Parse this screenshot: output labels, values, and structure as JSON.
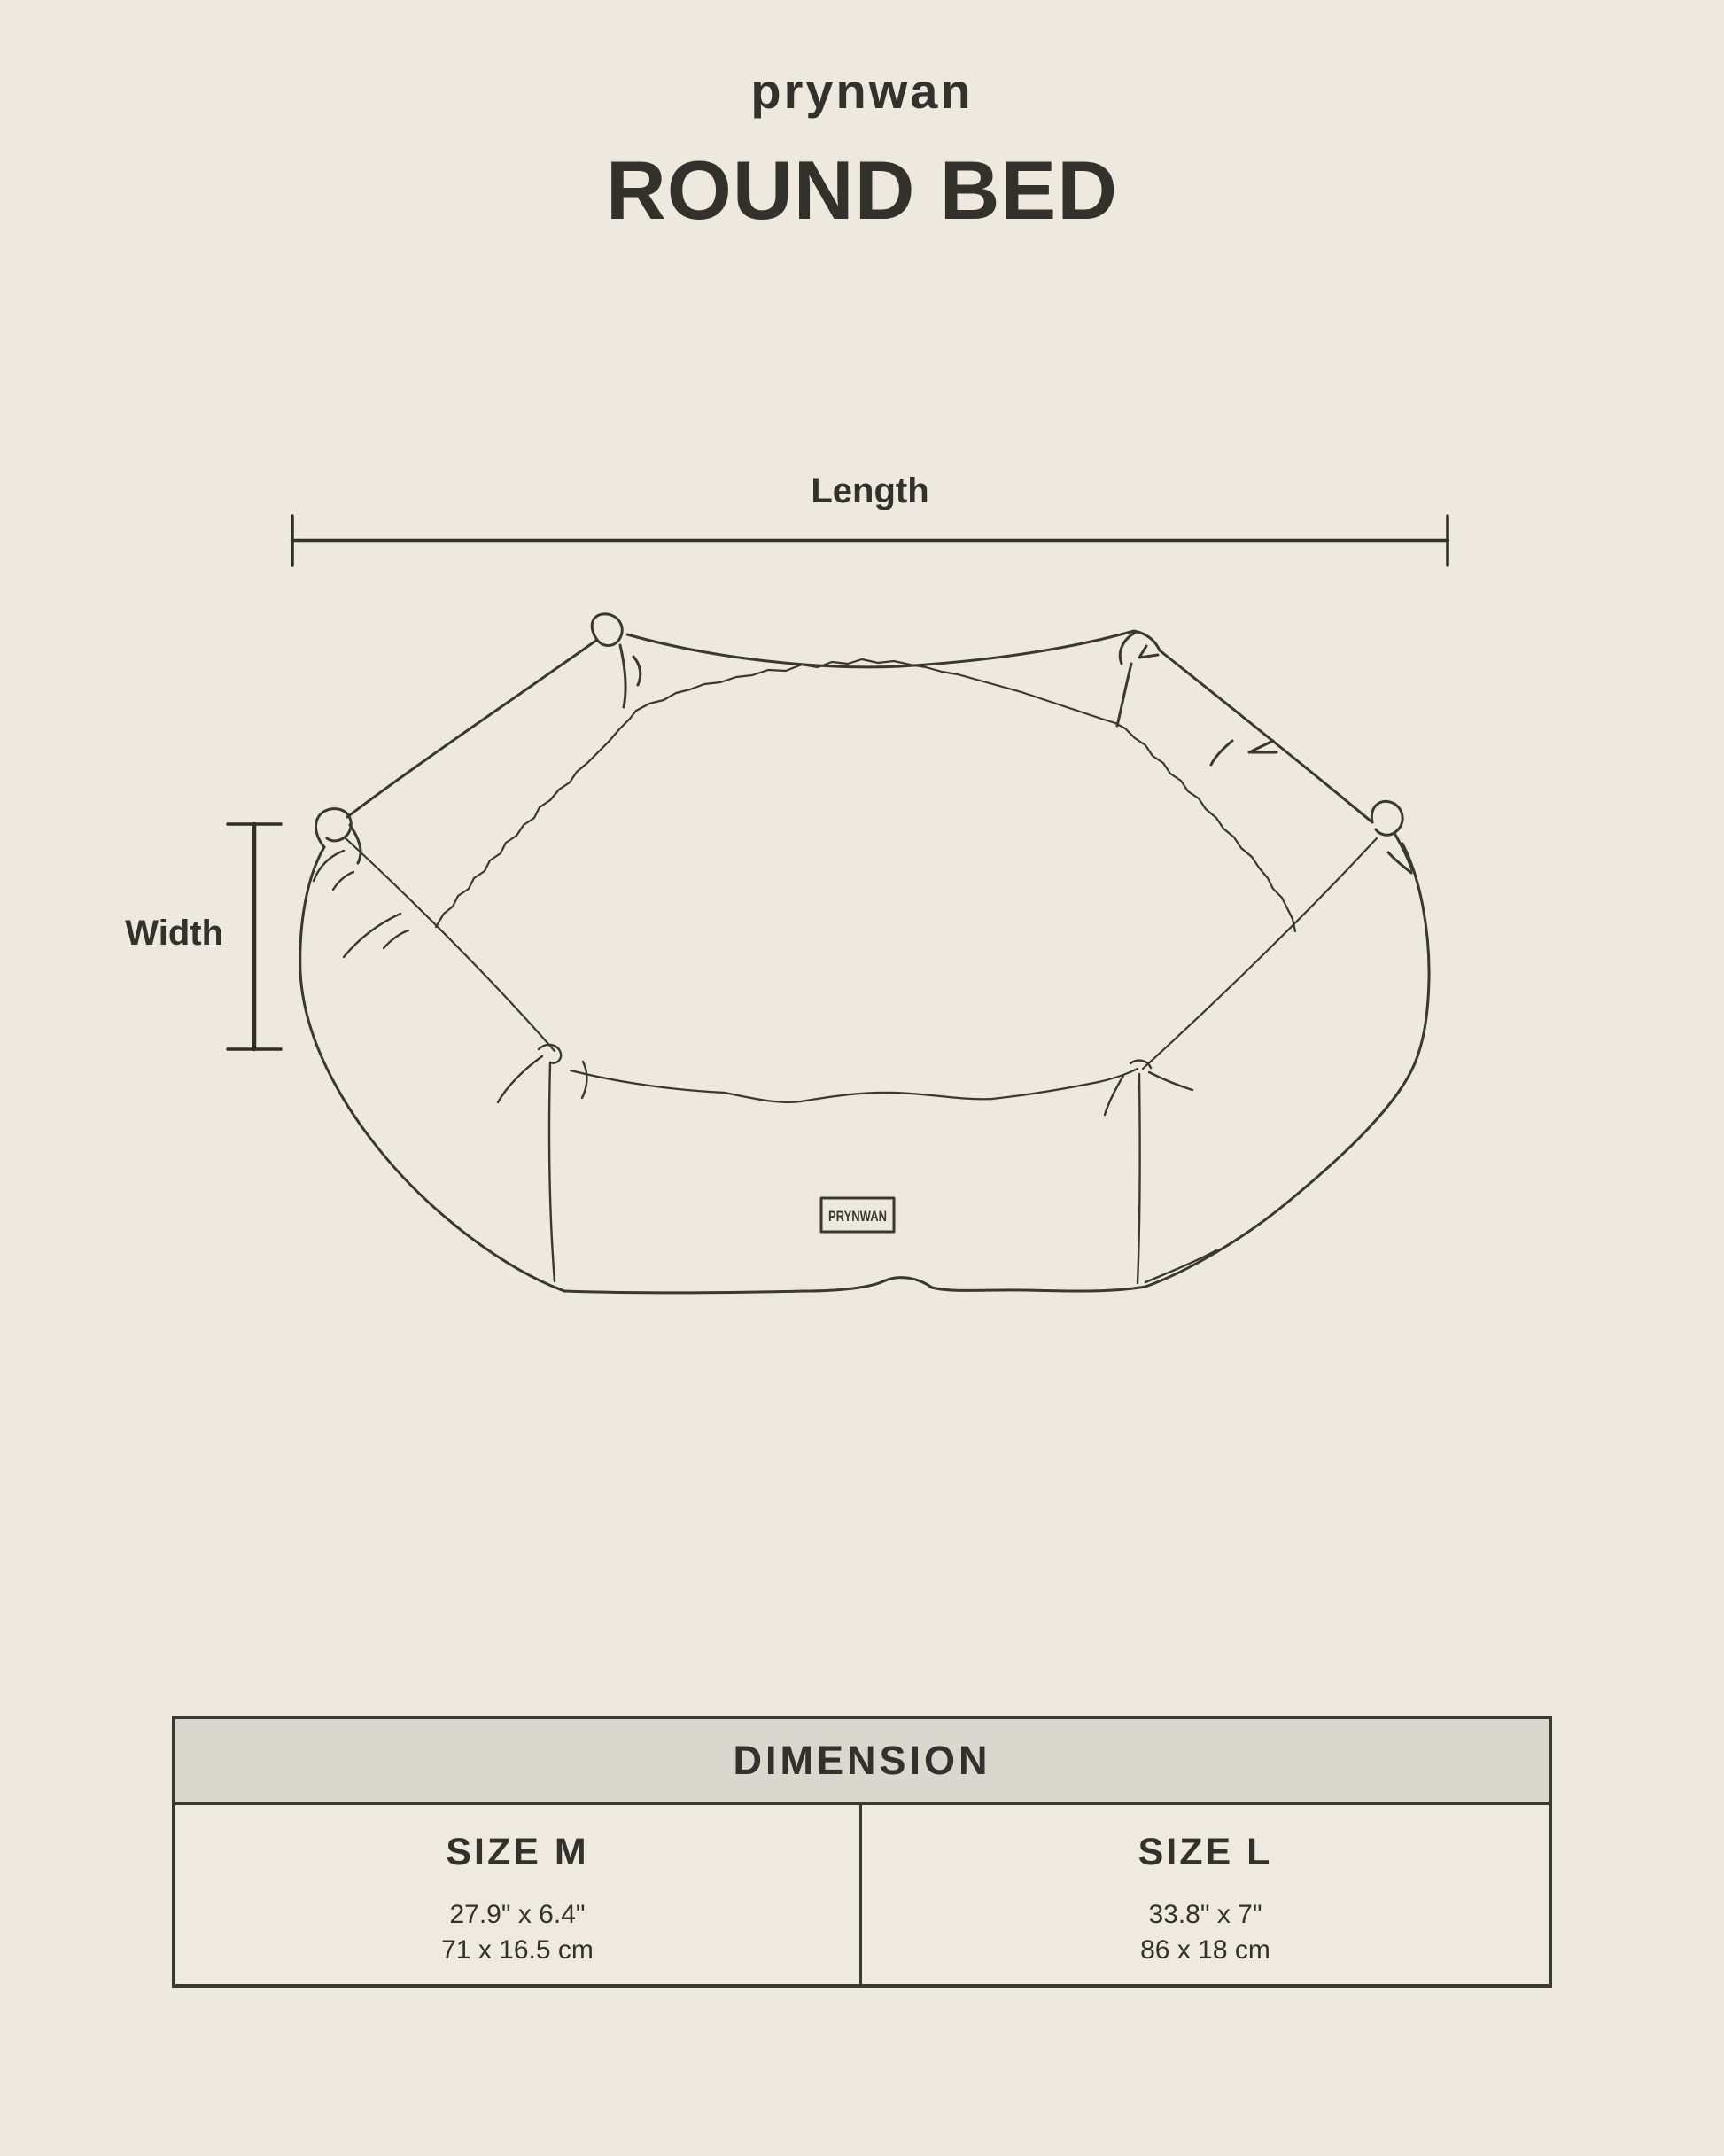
{
  "brand": "prynwan",
  "title": "ROUND BED",
  "diagram": {
    "length_label": "Length",
    "width_label": "Width",
    "bed_tag": "PRYNWAN"
  },
  "table": {
    "header": "DIMENSION",
    "columns": [
      {
        "size": "SIZE M",
        "inches": "27.9\" x 6.4\"",
        "cm": "71 x 16.5 cm"
      },
      {
        "size": "SIZE L",
        "inches": "33.8\" x 7\"",
        "cm": "86 x 18 cm"
      }
    ]
  },
  "colors": {
    "background": "#EDE9DE",
    "ink": "#393831",
    "table_header_bg": "#DAD7CF"
  }
}
